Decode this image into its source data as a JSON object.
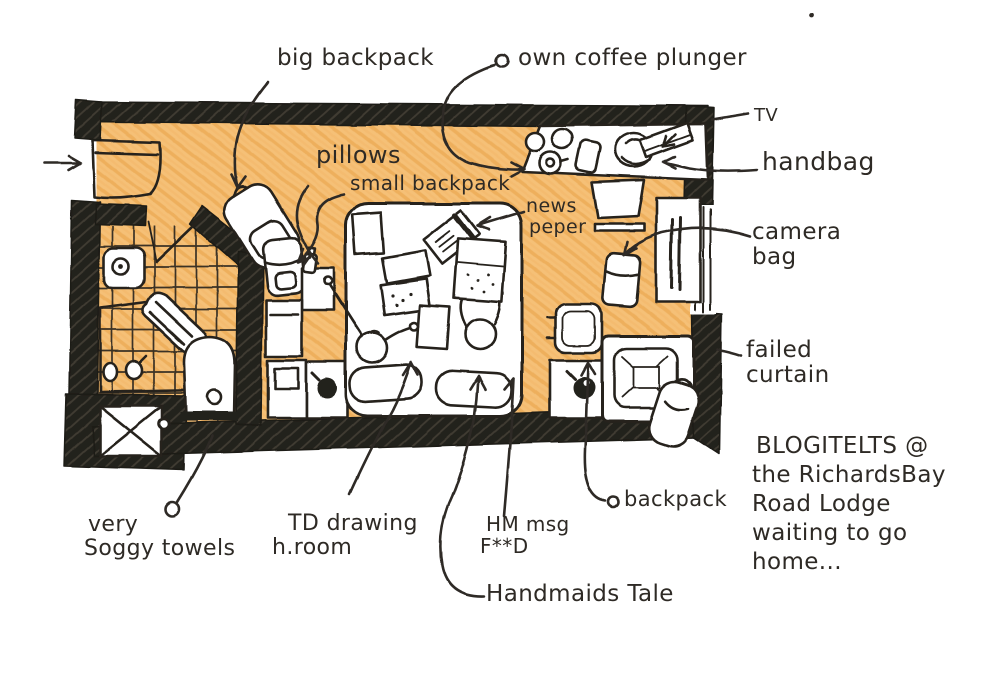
{
  "scene": {
    "description": "hand-drawn hotel room floor plan sketch with ink annotations and orange pencil floor"
  },
  "colors": {
    "ink": "#2e2a25",
    "wall_black": "#23201b",
    "floor_orange": "#f5c077",
    "floor_hatch": "#e59b3c",
    "paper": "#ffffff"
  },
  "labels": {
    "big_backpack": "big backpack",
    "own_coffee_plunger": "own coffee plunger",
    "tv": "TV",
    "handbag": "handbag",
    "pillows": "pillows",
    "small_backpack": "small backpack",
    "newspaper": [
      "news",
      "peper"
    ],
    "camera_bag": [
      "camera",
      "bag"
    ],
    "failed_curtain": [
      "failed",
      "curtain"
    ],
    "soggy_towels": [
      "very",
      "Soggy towels"
    ],
    "td_drawing": [
      "TD drawing",
      "h.room"
    ],
    "hm_msg": [
      "HM msg",
      "F**D"
    ],
    "handmaids_tale": "Handmaids Tale",
    "backpack": "backpack"
  },
  "caption": {
    "lines": [
      "BLOGITELTS @",
      "the RichardsBay",
      "Road Lodge",
      "waiting to go",
      "home..."
    ]
  },
  "icons": [
    "entrance-arrow-icon",
    "entry-door-icon",
    "sink-icon",
    "shower-tray-icon",
    "towels-icon",
    "toilet-icon",
    "crossed-box-icon",
    "big-backpack-icon",
    "small-backpack-icon",
    "luggage-icon",
    "bottle-icon",
    "bed-icon",
    "person-icon",
    "pillow-icon",
    "tablet-icon",
    "book-icon",
    "newspaper-icon",
    "cushion-icon",
    "nightstand-icon",
    "lamp-icon",
    "desk-icon",
    "cup-icon",
    "coffee-plunger-icon",
    "carton-icon",
    "handbag-icon",
    "tv-icon",
    "stool-icon",
    "camera-bag-icon",
    "curtain-icon",
    "window-icon",
    "side-table-icon",
    "armchair-icon",
    "backpack-icon"
  ]
}
